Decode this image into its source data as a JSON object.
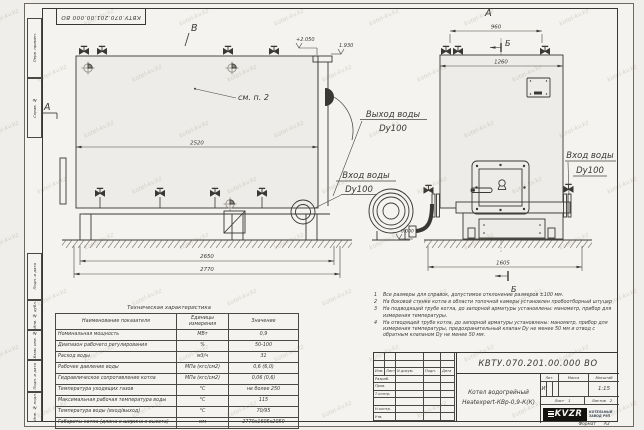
{
  "watermark": "kotel-kv.kz",
  "corner_stamp": "КВТУ.070.201.00.000 ВО",
  "margin_stamps": [
    "Перв. примен.",
    "Справ. №",
    "Подп. и дата",
    "Инв. № дубл.",
    "Взам. инв. №",
    "Подп. и дата",
    "Инв. № подл."
  ],
  "views": {
    "front": {
      "label_v": "В",
      "section_a": "А",
      "elev_top": "+2.050",
      "elev_pipe": "1.930",
      "see_note": "см. п. 2",
      "dim_top": "2520",
      "dim_mid": "2650",
      "dim_bot": "2770",
      "outlet_line1": "Выход воды",
      "outlet_line2": "Dy100",
      "inlet_line1": "Вход воды",
      "inlet_line2": "Dy100"
    },
    "side": {
      "view_label": "А",
      "dim_valves": "960",
      "section_b": "Б",
      "dim_body": "1260",
      "inlet_line1": "Вход воды",
      "inlet_line2": "Dy100",
      "elev_zero": "0.000",
      "dim_base": "1605",
      "section_b2": "Б"
    }
  },
  "tech_table": {
    "title": "Техническая характеристика",
    "headers": [
      "Наименование показателя",
      "Единицы измерения",
      "Значение"
    ],
    "rows": [
      [
        "Номинальная мощность",
        "МВт",
        "0,9"
      ],
      [
        "Диапазон рабочего регулирования",
        "%",
        "50-100"
      ],
      [
        "Расход воды",
        "м3/ч",
        "31"
      ],
      [
        "Рабочее давление воды",
        "МПа (кгс/см2)",
        "0,6 (6,0)"
      ],
      [
        "Гидравлическое сопротивление котла",
        "МПа (кгс/см2)",
        "0,06 (0,6)"
      ],
      [
        "Температура уходящих газов",
        "°С",
        "не более 250"
      ],
      [
        "Максимальная рабочая температура воды",
        "°С",
        "115"
      ],
      [
        "Температура воды (вход/выход)",
        "°С",
        "70/95"
      ],
      [
        "Габариты котла (длина х ширина х высота)",
        "мм",
        "2770х1605х2050"
      ]
    ]
  },
  "notes": [
    {
      "num": "1",
      "text": "Все размеры для справок, допустимое отклонение размеров ±100 мм."
    },
    {
      "num": "2",
      "text": "На боковой стенке котла в области топочной камеры установлен пробоотборный штуцер"
    },
    {
      "num": "3",
      "text": "На подводящей трубе котла, до запорной арматуры установлены: манометр, прибор для измерения температуры."
    },
    {
      "num": "4",
      "text": "На отводящей трубе котла, до запорной арматуры установлены: манометр, прибор для измерения температуры, предохранительный клапан Dу не менее 50 мм и отвод с обратным клапаном Dу не менее 50 мм."
    }
  ],
  "title_block": {
    "doc_number": "КВТУ.070.201.00.000 ВО",
    "header_cols": [
      "Изм.",
      "Лист",
      "N докум.",
      "Подп.",
      "Дата"
    ],
    "row_labels": [
      "Разраб.",
      "Пров.",
      "Т.контр.",
      "",
      "Н.контр.",
      "Утв."
    ],
    "name_line1": "Котел водогрейный",
    "name_line2": "Heatexpert-КВр-0,9-К(К)",
    "lit_label": "Лит.",
    "lit_value": "И",
    "mass_label": "Масса",
    "scale_label": "Масштаб",
    "scale_value": "1:15",
    "sheet_label": "Лист",
    "sheet_value": "1",
    "sheets_label": "Листов",
    "sheets_value": "2",
    "logo_text": "KVZR",
    "company_line1": "КОТЕЛЬНЫЙ",
    "company_line2": "ЗАВОД РЭП",
    "format_label": "Формат",
    "format_value": "А3"
  }
}
